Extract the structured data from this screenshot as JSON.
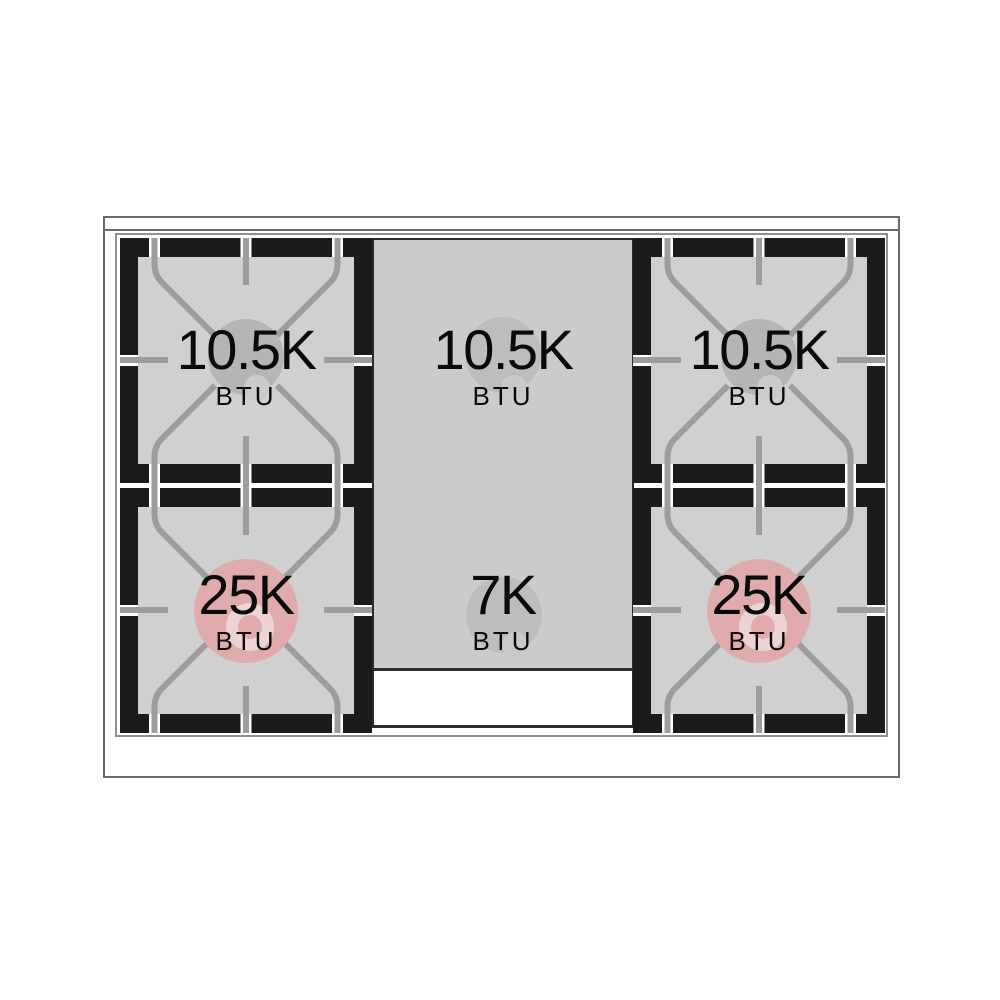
{
  "cooktop": {
    "burners": {
      "top_left": {
        "value": "10.5K",
        "unit": "BTU"
      },
      "top_center": {
        "value": "10.5K",
        "unit": "BTU"
      },
      "top_right": {
        "value": "10.5K",
        "unit": "BTU"
      },
      "bottom_left": {
        "value": "25K",
        "unit": "BTU"
      },
      "bottom_center": {
        "value": "7K",
        "unit": "BTU"
      },
      "bottom_right": {
        "value": "25K",
        "unit": "BTU"
      }
    },
    "colors": {
      "outline": "#6a6a6a",
      "cooktop-line": "#8f8f8f",
      "module-black": "#1b1b1b",
      "well-gray": "#d0d0d0",
      "column-gray": "#cbcbcb",
      "column-line": "#2b2b2b",
      "grate-line": "#9d9d9d",
      "burner-gray": "#b5b5b5",
      "burner-gray-light": "#cbcbcb",
      "column-burner": "#bdbdbd",
      "column-burner-light": "#c9c9c9",
      "power-pink": "#dfabad",
      "power-pink-light": "#ecd4d4",
      "label-text": "#0a0a0a"
    }
  }
}
